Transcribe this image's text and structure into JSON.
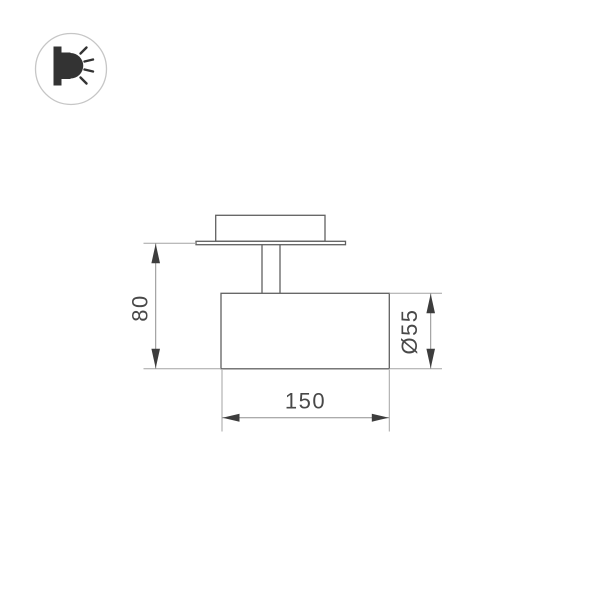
{
  "page": {
    "background_color": "#ffffff",
    "kind": "technical dimension drawing"
  },
  "logo": {
    "icon": "wall-light-icon",
    "circle_color": "#c6c6c6",
    "icon_color": "#333333"
  },
  "drawing": {
    "object_line_color": "#606060",
    "dimension_line_color": "#8f8f8f",
    "extension_line_color": "#a3a3a3",
    "arrow_color": "#3d3d3d",
    "text_color": "#484848",
    "dimensions": [
      {
        "id": "height",
        "label": "80"
      },
      {
        "id": "diameter",
        "label": "Ø55"
      },
      {
        "id": "length",
        "label": "150"
      }
    ]
  }
}
